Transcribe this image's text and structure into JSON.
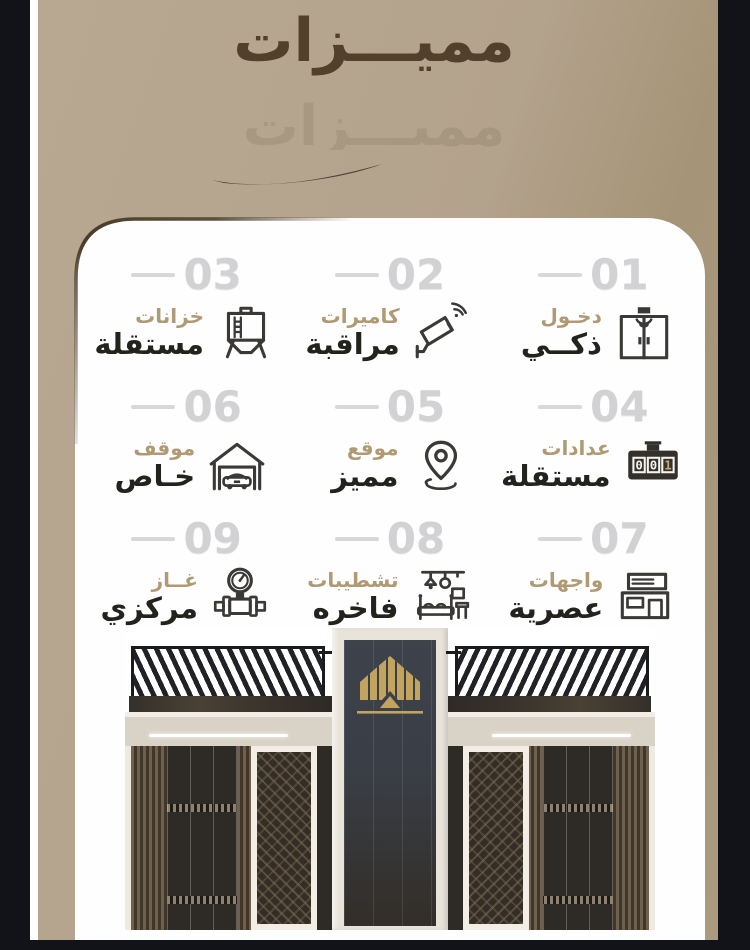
{
  "header": {
    "title": "مميـــزات",
    "ghost_title": "مميـــزات"
  },
  "features": [
    {
      "num": "01",
      "line1": "دخـول",
      "line2": "ذكــي",
      "icon": "smart-entry-icon"
    },
    {
      "num": "02",
      "line1": "كاميرات",
      "line2": "مراقبة",
      "icon": "cctv-camera-icon"
    },
    {
      "num": "03",
      "line1": "خزانات",
      "line2": "مستقلة",
      "icon": "water-tank-icon"
    },
    {
      "num": "04",
      "line1": "عدادات",
      "line2": "مستقلة",
      "icon": "utility-meter-icon",
      "icon_digits": {
        "d1": "0",
        "d2": "0",
        "d3": "1"
      }
    },
    {
      "num": "05",
      "line1": "موقع",
      "line2": "مميز",
      "icon": "location-pin-icon"
    },
    {
      "num": "06",
      "line1": "موقف",
      "line2": "خـاص",
      "icon": "garage-car-icon"
    },
    {
      "num": "07",
      "line1": "واجهات",
      "line2": "عصرية",
      "icon": "building-facade-icon"
    },
    {
      "num": "08",
      "line1": "تشطيبات",
      "line2": "فاخره",
      "icon": "luxury-furniture-icon"
    },
    {
      "num": "09",
      "line1": "غــاز",
      "line2": "مركزي",
      "icon": "gas-meter-icon"
    }
  ],
  "building": {
    "logo_icon": "gold-house-logo-icon"
  },
  "colors": {
    "background_tan": "#b3a28c",
    "title_brown": "#52402c",
    "accent_gold": "#b09a74",
    "text_dark": "#24221d",
    "number_gray": "#d2d2d5",
    "card_white": "#fefefe",
    "pillar_black": "#111318",
    "logo_gold": "#c2a45e"
  }
}
